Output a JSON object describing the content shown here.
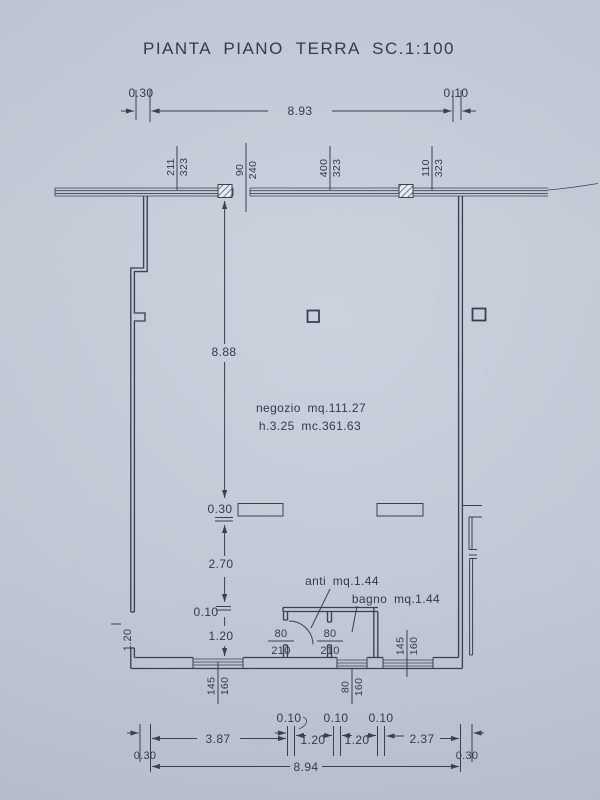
{
  "colors": {
    "paper": "#c5ccda",
    "ink": "#39414f"
  },
  "title": "PIANTA PIANO TERRA SC.1:100",
  "rooms": {
    "negozio": {
      "line1": "negozio mq.111.27",
      "line2": "h.3.25 mc.361.63"
    },
    "anti": {
      "label": "anti mq.1.44"
    },
    "bagno": {
      "label": "bagno mq.1.44"
    }
  },
  "top_dimension": {
    "left": "0.30",
    "span": "8.93",
    "right": "0.10"
  },
  "front_openings": [
    {
      "w": "211",
      "h": "323"
    },
    {
      "w": "90",
      "h": "240"
    },
    {
      "w": "400",
      "h": "323"
    },
    {
      "w": "110",
      "h": "323"
    }
  ],
  "vertical_dimensions": {
    "depth": "8.88",
    "beam": "0.30",
    "mid": "2.70",
    "wall": "0.10",
    "lower": "1.20"
  },
  "left_wall_dimension": "1.20",
  "doors": [
    {
      "w": "80",
      "h": "210"
    },
    {
      "w": "80",
      "h": "210"
    }
  ],
  "rear_windows": [
    {
      "w": "145",
      "h": "160"
    },
    {
      "w": "80",
      "h": "160"
    },
    {
      "w": "145",
      "h": "160"
    }
  ],
  "bottom_dimensions": {
    "gaps": [
      "0.10",
      "0.10",
      "0.10"
    ],
    "segments": [
      "3.87",
      "1.20",
      "1.20",
      "2.37"
    ],
    "left": "0.30",
    "right": "0.30",
    "total": "8.94"
  }
}
